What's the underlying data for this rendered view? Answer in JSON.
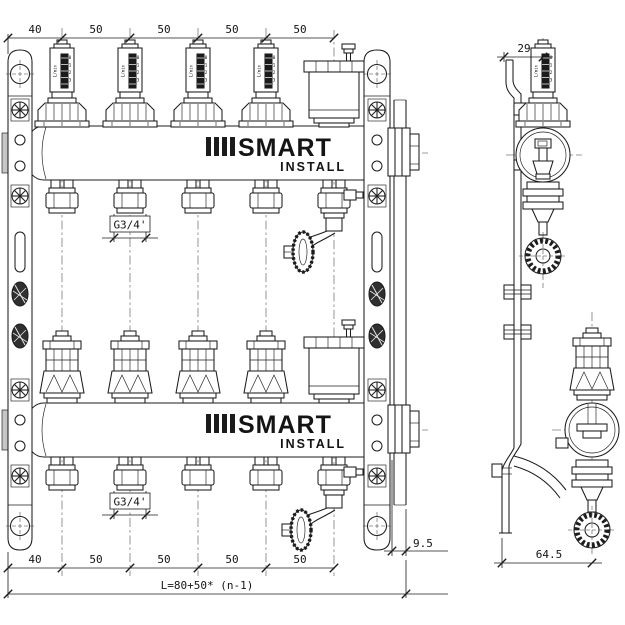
{
  "logo": {
    "name": "SMART",
    "sub": "INSTALL"
  },
  "flowmeter": {
    "unit": "L/min",
    "marks": [
      "0",
      "1",
      "2",
      "3"
    ]
  },
  "dims": {
    "top": [
      "40",
      "50",
      "50",
      "50",
      "50"
    ],
    "bottom": [
      "40",
      "50",
      "50",
      "50",
      "50"
    ],
    "side_width": "29",
    "right_offset": "9.5",
    "bracket_depth": "64.5",
    "length_formula": "L=80+50* (n-1)"
  },
  "threads": {
    "supply": "G3/4'",
    "return": "G3/4'"
  }
}
